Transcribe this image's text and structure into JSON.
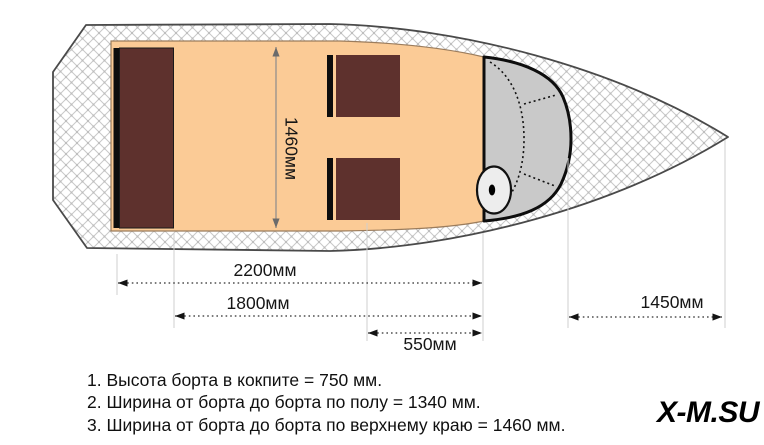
{
  "diagram": {
    "dimensions": {
      "cockpit_total_length": "2200мм",
      "cockpit_floor_length": "1800мм",
      "console_section_length": "550мм",
      "bow_deck_length": "1450мм",
      "cockpit_width": "1460мм"
    },
    "notes": [
      "1. Высота борта в кокпите = 750 мм.",
      "2. Ширина от борта до борта по полу = 1340 мм.",
      "3. Ширина от борта до борта по верхнему краю = 1460 мм."
    ],
    "watermark": "X-M.SU",
    "colors": {
      "cockpit_floor": "#fbcb96",
      "cockpit_border": "#9b7c5c",
      "seat": "#5e312d",
      "seat_backrest": "#0d0d0d",
      "windshield": "#c9c9c9",
      "transom_pad": "#a6a6a6",
      "hull_line": "#4a4a4a",
      "hatch_line": "#c9c9c9",
      "dim_line": "#2e2e2e",
      "extension_line": "#cfcfcf"
    }
  }
}
